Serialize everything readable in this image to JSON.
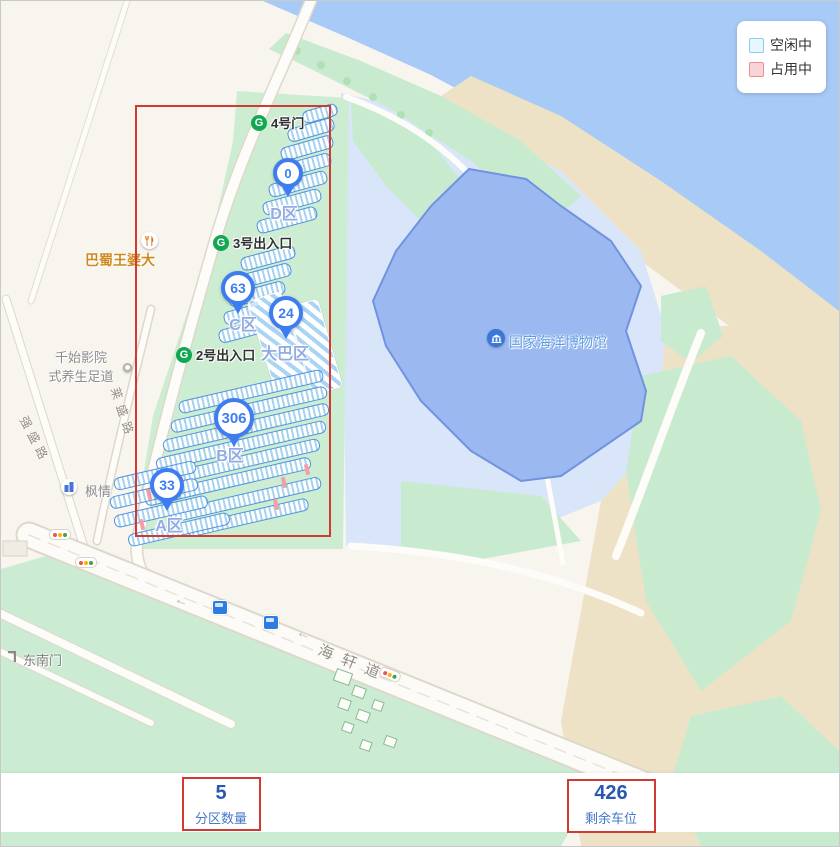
{
  "legend": {
    "items": [
      {
        "label": "空闲中",
        "fill": "#e8f6fe",
        "border": "#88cdf2"
      },
      {
        "label": "占用中",
        "fill": "#f9d3d5",
        "border": "#ee8d92"
      }
    ]
  },
  "map": {
    "gates": [
      {
        "label": "4号门"
      },
      {
        "label": "3号出入口"
      },
      {
        "label": "2号出入口"
      }
    ],
    "markers": [
      {
        "count": "0",
        "zone": "D区"
      },
      {
        "count": "63",
        "zone": "C区"
      },
      {
        "count": "24",
        "zone": "大巴区"
      },
      {
        "count": "306",
        "zone": "B区"
      },
      {
        "count": "33",
        "zone": "A区"
      }
    ],
    "pois": {
      "restaurant": {
        "label": "巴蜀王婆大"
      },
      "cinema": {
        "line1": "千始影院",
        "line2": "式养生足道"
      },
      "fengqing": {
        "label": "枫情"
      },
      "se_gate": {
        "label": "东南门"
      },
      "museum": {
        "label": "国家海洋博物馆"
      }
    },
    "road_labels": {
      "haixuan": "海轩道",
      "laisheng": "莱盛路",
      "qiangsheng": "强盛路"
    }
  },
  "icons": {
    "gate_glyph": "G",
    "road_arrow": "←"
  },
  "stats": {
    "partitions": {
      "value": "5",
      "label": "分区数量"
    },
    "remaining": {
      "value": "426",
      "label": "剩余车位"
    }
  },
  "colors": {
    "marker_blue": "#3e7df1",
    "free_fill": "#e8f6fe",
    "occupied_fill": "#f9d3d5",
    "annotation_red": "#cf3b33",
    "water": "#a7caf7",
    "park_green": "#cdedd2",
    "museum_fill": "#9cb8f0"
  }
}
